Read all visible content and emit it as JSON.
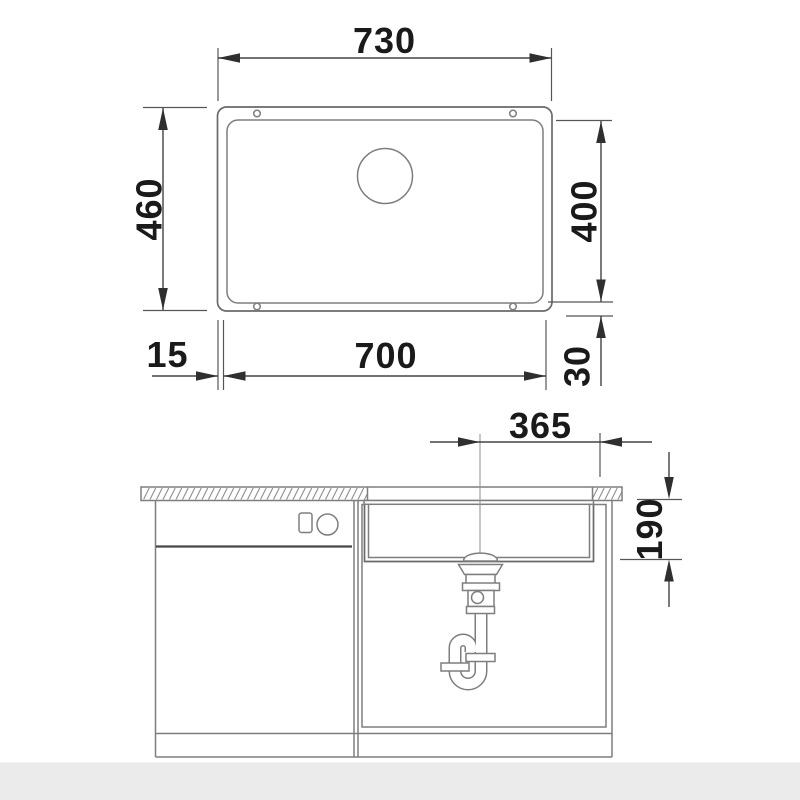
{
  "drawing_title": "sink-installation-dimension-drawing",
  "colors": {
    "background": "#ffffff",
    "footer_band": "#ebebeb",
    "drawing_line": "#7e7e7e",
    "dimension_line": "#434343",
    "label_text": "#1a1a1a",
    "hatch_line": "#8f8f8f"
  },
  "top_view": {
    "outer_width_mm": "730",
    "overall_depth_mm": "460",
    "bowl_depth_mm": "400",
    "bowl_width_mm": "700",
    "side_offset_mm": "15",
    "bottom_offset_mm": "30"
  },
  "front_view": {
    "drain_to_edge_mm": "365",
    "bowl_height_mm": "190"
  }
}
